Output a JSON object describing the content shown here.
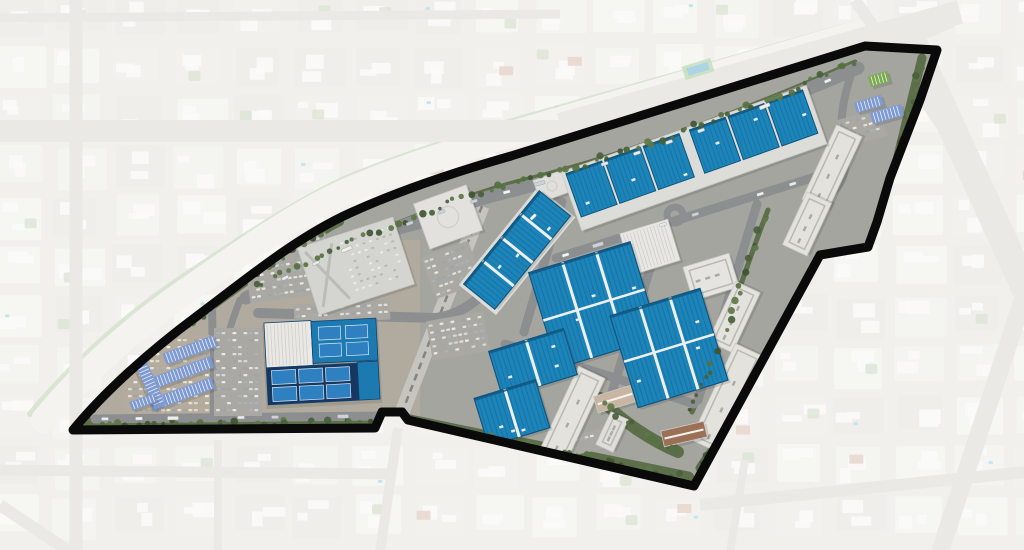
{
  "scene": {
    "width": 1024,
    "height": 550
  },
  "colors": {
    "bg_base": "#e7e5e1",
    "block_palette": [
      "#f0efeb",
      "#e9e7e2",
      "#edece7",
      "#e4e2dd"
    ],
    "block_building": "#f7f6f3",
    "block_green": "#c6d2b8",
    "block_pool": "#9fd2e2",
    "block_red_roof": "#d6b9a9",
    "outside_road": "#dcdad5",
    "veil": "#ffffff",
    "veil_opacity": 0.42,
    "channel_fill": "#eceae5",
    "channel_green": "#b2c9a2",
    "site_base": "#a5a5a0",
    "site_left_ground": "#b3ac9f",
    "road_in": "#8d8e90",
    "busway_base": "#c5c4bf",
    "busway_rail": "#85857f",
    "lot_fill": "#a9a8a3",
    "lot_tan": "#b4ab9c",
    "green_band": "#556840",
    "tree_palette": [
      "#49603a",
      "#557040",
      "#3f5531",
      "#5d7845"
    ],
    "white_building": "#e3e2dd",
    "pad_fill": "#dcddd8",
    "warehouse_blue": "#1d84b8",
    "warehouse_stripe": "#1570a6",
    "warehouse_trim": "#10557f",
    "divider_white": "#eef0ee",
    "canopy_blue": "#7e9ad2",
    "canopy_green": "#7cab50",
    "navy_court_base": "#173760",
    "court_blue": "#2f80c0",
    "court_edge": "#d8e8f4",
    "boundary_black": "#0a0a0a",
    "car_palette": [
      "#eef0ef",
      "#d8dde0",
      "#aab3ba",
      "#e8e6df",
      "#9aa4ab"
    ],
    "vehicle_palette": [
      "#f5f6f5",
      "#e8ebed",
      "#ccd3d8",
      "#f0efe9"
    ],
    "shadow": "#30342c"
  },
  "boundary": {
    "path": "M 73,430 C 104,392 150,351 197,316 C 244,281 295,238 350,213 C 405,188 462,170 511,156 L 865,46 L 937,50 L 920,100 L 890,178 L 877,222 L 868,247 L 820,255 L 790,310 L 694,486 L 408,420 L 402,412 L 382,412 L 375,428 Z",
    "stroke_width": 9
  },
  "outside": {
    "channel": {
      "d": "M 44,420 C 80,376 130,330 185,292 C 240,254 292,216 345,192 C 400,168 460,150 505,136 L 862,32",
      "w": 26
    },
    "channel_green": {
      "d": "M 30,414 C 70,366 122,318 178,280 C 235,242 290,205 342,180 C 398,156 458,138 502,124 L 860,22",
      "w": 6
    },
    "roads": [
      {
        "d": "M 0,131 L 660,131",
        "w": 22
      },
      {
        "d": "M 0,18 L 560,14",
        "w": 9
      },
      {
        "d": "M 76,0 L 76,550",
        "w": 13
      },
      {
        "d": "M 0,470 L 390,474",
        "w": 11
      },
      {
        "d": "M 218,440 L 218,550",
        "w": 8
      },
      {
        "d": "M 660,131 C 760,100 850,60 950,18",
        "w": 20
      },
      {
        "d": "M 560,125 L 960,12",
        "w": 24
      },
      {
        "d": "M 905,25 L 1026,290",
        "w": 28
      },
      {
        "d": "M 1026,290 L 940,552",
        "w": 18
      },
      {
        "d": "M 855,0 L 980,180",
        "w": 12
      },
      {
        "d": "M 700,505 L 1026,472",
        "w": 12
      },
      {
        "d": "M 745,460 L 730,552",
        "w": 8
      },
      {
        "d": "M 0,505 L 70,552",
        "w": 12
      },
      {
        "d": "M 398,428 L 380,552",
        "w": 10
      }
    ],
    "landmarks": [
      {
        "x": 683,
        "y": 62,
        "w": 30,
        "h": 14,
        "rot": -17,
        "fill": "#9fc98f",
        "inner": "#6db3d8"
      }
    ],
    "blocks": {
      "cols": 18,
      "rows": 11,
      "cell_w": 60,
      "cell_h": 50,
      "block_w": 52,
      "block_h": 42
    }
  },
  "site": {
    "left_ground": {
      "x": 60,
      "y": 240,
      "w": 360,
      "h": 200
    },
    "greens": [
      {
        "d": "M 85,424 L 372,422 M 395,418 L 688,478",
        "w": 13
      },
      {
        "d": "M 700,468 L 748,398 L 792,308 L 822,257 L 866,250 L 880,222 L 893,176 L 922,58",
        "w": 9
      },
      {
        "d": "M 252,290 C 350,240 450,200 516,182 C 600,162 720,122 855,62",
        "w": 5
      },
      {
        "d": "M 82,420 C 110,385 150,348 196,318 C 240,286 290,248 340,222",
        "w": 8
      },
      {
        "d": "M 600,398 C 620,420 650,440 678,452",
        "w": 12
      },
      {
        "d": "M 768,210 C 752,250 740,290 724,330 M 716,350 C 708,375 700,395 692,412",
        "w": 5
      }
    ],
    "busway": {
      "d": "M 482,206 L 396,428",
      "w": 15
    },
    "roads": [
      {
        "id": "blvd",
        "d": "M 246,298 C 340,248 440,208 515,190 C 600,168 720,127 858,68",
        "w": 13
      },
      {
        "id": "ew",
        "d": "M 258,313 L 436,318",
        "w": 10
      },
      {
        "id": "crossup",
        "d": "M 436,318 C 478,312 500,276 514,246 C 524,226 538,206 558,202",
        "w": 10
      },
      {
        "id": "s1",
        "d": "M 556,258 L 818,176",
        "w": 9
      },
      {
        "id": "c1",
        "d": "M 562,202 L 524,332",
        "w": 9
      },
      {
        "id": "c2",
        "d": "M 662,230 L 612,392",
        "w": 9
      },
      {
        "id": "c3",
        "d": "M 757,204 L 698,400",
        "w": 9
      },
      {
        "id": "lowconn",
        "d": "M 505,344 C 565,362 630,382 694,404",
        "w": 9
      },
      {
        "id": "bottomrd",
        "d": "M 95,419 L 380,416",
        "w": 9
      },
      {
        "id": "leftv",
        "d": "M 212,308 L 214,418",
        "w": 8
      },
      {
        "id": "leftentry",
        "d": "M 240,300 C 228,330 220,360 217,396",
        "w": 7
      },
      {
        "id": "toploop",
        "d": "M 852,72 C 843,98 838,124 844,152 C 848,172 842,188 826,196",
        "w": 8
      },
      {
        "id": "garagerd",
        "d": "M 300,257 L 420,225",
        "w": 8
      }
    ],
    "roundabout": {
      "cx": 675,
      "cy": 215,
      "r": 8
    },
    "lots": [
      {
        "cx": 288,
        "cy": 268,
        "w": 84,
        "h": 60,
        "rot": -8,
        "tan": false
      },
      {
        "cx": 238,
        "cy": 372,
        "w": 48,
        "h": 88,
        "rot": 0,
        "tan": false
      },
      {
        "cx": 168,
        "cy": 374,
        "w": 84,
        "h": 78,
        "rot": 0,
        "tan": true
      },
      {
        "cx": 342,
        "cy": 312,
        "w": 96,
        "h": 20,
        "rot": -3,
        "tan": false
      },
      {
        "cx": 452,
        "cy": 270,
        "w": 50,
        "h": 44,
        "rot": -20,
        "tan": false
      },
      {
        "cx": 458,
        "cy": 336,
        "w": 58,
        "h": 40,
        "rot": -10,
        "tan": false
      },
      {
        "cx": 592,
        "cy": 441,
        "w": 50,
        "h": 20,
        "rot": -13,
        "tan": false
      },
      {
        "cx": 862,
        "cy": 128,
        "w": 44,
        "h": 28,
        "rot": -15,
        "tan": false
      }
    ],
    "pads": [
      {
        "cx": 517,
        "cy": 251,
        "w": 126,
        "h": 48,
        "rot": -51
      }
    ],
    "white_buildings": [
      {
        "cx": 356,
        "cy": 266,
        "w": 100,
        "h": 70,
        "rot": -18,
        "fill": "#d4d4d0",
        "detail": "garage"
      },
      {
        "cx": 448,
        "cy": 217,
        "w": 56,
        "h": 48,
        "rot": -20,
        "fill": "#e2e1dd",
        "detail": "plain"
      },
      {
        "cx": 650,
        "cy": 247,
        "w": 50,
        "h": 43,
        "rot": -17,
        "fill": "#e8e7e3",
        "detail": "ribs"
      },
      {
        "cx": 711,
        "cy": 277,
        "w": 48,
        "h": 35,
        "rot": -17,
        "fill": "#e5e4e0",
        "detail": "court"
      },
      {
        "cx": 552,
        "cy": 186,
        "w": 32,
        "h": 23,
        "rot": -20,
        "fill": "#e0dfdb",
        "detail": "plain"
      },
      {
        "cx": 832,
        "cy": 168,
        "w": 82,
        "h": 28,
        "rot": -65,
        "fill": "#e3e2dd",
        "detail": "court"
      },
      {
        "cx": 807,
        "cy": 224,
        "w": 58,
        "h": 27,
        "rot": -65,
        "fill": "#e3e2dd",
        "detail": "court"
      },
      {
        "cx": 734,
        "cy": 317,
        "w": 66,
        "h": 27,
        "rot": -65,
        "fill": "#e3e2dd",
        "detail": "court"
      },
      {
        "cx": 727,
        "cy": 398,
        "w": 106,
        "h": 31,
        "rot": -65,
        "fill": "#e3e2dd",
        "detail": "court"
      },
      {
        "cx": 572,
        "cy": 415,
        "w": 94,
        "h": 29,
        "rot": -65,
        "fill": "#e3e2dd",
        "detail": "court"
      },
      {
        "cx": 612,
        "cy": 432,
        "w": 36,
        "h": 19,
        "rot": -65,
        "fill": "#dfdeda",
        "detail": "court"
      },
      {
        "cx": 615,
        "cy": 399,
        "w": 40,
        "h": 17,
        "rot": -17,
        "fill": "#c8b6a2",
        "detail": "ridge"
      },
      {
        "cx": 684,
        "cy": 434,
        "w": 44,
        "h": 16,
        "rot": -13,
        "fill": "#9c7056",
        "detail": "ridge"
      }
    ],
    "warehouses": [
      {
        "cx": 517,
        "cy": 250,
        "w": 120,
        "h": 40,
        "rot": -51,
        "divs": 3
      },
      {
        "cx": 594,
        "cy": 305,
        "w": 106,
        "h": 100,
        "rot": -17,
        "divs": 2,
        "grid": true
      },
      {
        "cx": 669,
        "cy": 348,
        "w": 94,
        "h": 96,
        "rot": -17,
        "divs": 2,
        "grid": true
      },
      {
        "cx": 533,
        "cy": 363,
        "w": 78,
        "h": 48,
        "rot": -17,
        "divs": 1
      },
      {
        "cx": 512,
        "cy": 413,
        "w": 64,
        "h": 50,
        "rot": -17,
        "divs": 1
      }
    ],
    "top_cluster": {
      "cx": 694,
      "cy": 158,
      "w": 260,
      "h": 62,
      "rot": -19.5,
      "section_h": 46,
      "section_voff": -5,
      "sections": [
        {
          "u": -107,
          "w": 38
        },
        {
          "u": -66,
          "w": 38
        },
        {
          "u": -25,
          "w": 38
        },
        {
          "u": 24,
          "w": 38
        },
        {
          "u": 65,
          "w": 38
        },
        {
          "u": 106,
          "w": 38
        }
      ]
    },
    "sports_complex": {
      "rot": -3,
      "ox": 322,
      "oy": 361,
      "rects": [
        {
          "x": 266,
          "y": 320,
          "w": 47,
          "h": 45,
          "fill": "#e9e8e4",
          "detail": "ribs"
        },
        {
          "x": 313,
          "y": 321,
          "w": 65,
          "h": 42,
          "fill": "#1c7ab0",
          "detail": ""
        },
        {
          "x": 357,
          "y": 364,
          "w": 21,
          "h": 38,
          "fill": "#1c7ab0",
          "detail": ""
        },
        {
          "x": 266,
          "y": 365,
          "w": 91,
          "h": 37,
          "fill": "#173760",
          "detail": ""
        }
      ],
      "courts": [
        {
          "x": 320,
          "y": 327,
          "w": 22,
          "h": 13
        },
        {
          "x": 347,
          "y": 327,
          "w": 22,
          "h": 13
        },
        {
          "x": 320,
          "y": 344,
          "w": 22,
          "h": 13
        },
        {
          "x": 347,
          "y": 344,
          "w": 22,
          "h": 13
        },
        {
          "x": 271,
          "y": 368,
          "w": 24,
          "h": 14
        },
        {
          "x": 298,
          "y": 368,
          "w": 24,
          "h": 14
        },
        {
          "x": 325,
          "y": 368,
          "w": 24,
          "h": 14
        },
        {
          "x": 271,
          "y": 385,
          "w": 24,
          "h": 14
        },
        {
          "x": 298,
          "y": 385,
          "w": 24,
          "h": 14
        },
        {
          "x": 325,
          "y": 385,
          "w": 24,
          "h": 14
        }
      ]
    },
    "canopies": [
      {
        "cx": 190,
        "cy": 350,
        "w": 54,
        "h": 12,
        "rot": -20,
        "green": false
      },
      {
        "cx": 184,
        "cy": 372,
        "w": 60,
        "h": 12,
        "rot": -20,
        "green": false
      },
      {
        "cx": 182,
        "cy": 394,
        "w": 66,
        "h": 12,
        "rot": -20,
        "green": false
      },
      {
        "cx": 151,
        "cy": 386,
        "w": 46,
        "h": 12,
        "rot": 66,
        "green": false
      },
      {
        "cx": 143,
        "cy": 402,
        "w": 26,
        "h": 9,
        "rot": -20,
        "green": false
      },
      {
        "cx": 869,
        "cy": 104,
        "w": 28,
        "h": 11,
        "rot": -16,
        "green": false
      },
      {
        "cx": 887,
        "cy": 114,
        "w": 32,
        "h": 12,
        "rot": -16,
        "green": false
      },
      {
        "cx": 879,
        "cy": 79,
        "w": 20,
        "h": 11,
        "rot": -16,
        "green": true
      }
    ],
    "vehicle_roads": [
      "blvd",
      "s1",
      "bottomrd",
      "crossup"
    ],
    "vehicle_step": 34,
    "tree_step": 9
  }
}
